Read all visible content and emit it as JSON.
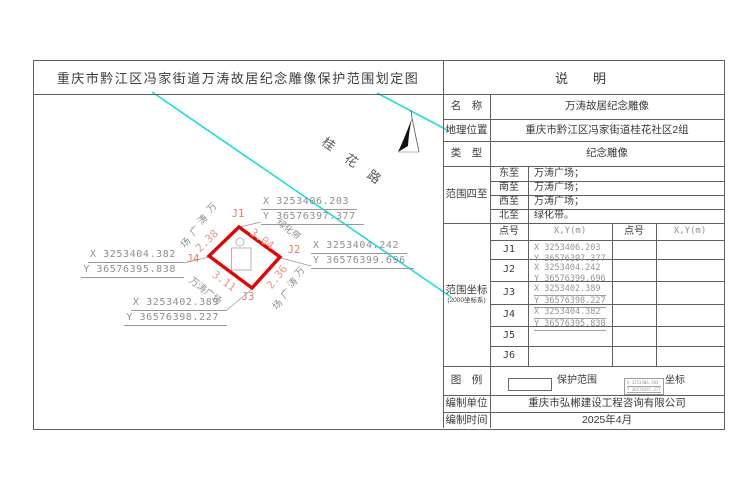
{
  "title": "重庆市黔江区冯家街道万涛故居纪念雕像保护范围划定图",
  "map": {
    "road_label": "桂花路",
    "green_belt_label": "绿化带",
    "square_labels": [
      "万涛广场",
      "万涛广场",
      "万涛广场"
    ],
    "points": [
      {
        "id": "J1",
        "x": "X 3253406.203",
        "y": "Y 36576397.377"
      },
      {
        "id": "J2",
        "x": "X 3253404.242",
        "y": "Y 36576399.696"
      },
      {
        "id": "J3",
        "x": "X 3253402.389",
        "y": "Y 36576398.227"
      },
      {
        "id": "J4",
        "x": "X 3253404.382",
        "y": "Y 36576395.838"
      }
    ],
    "side_lengths": [
      "2.38",
      "3.04",
      "2.36",
      "3.11"
    ]
  },
  "table": {
    "header": "说　明",
    "rows": {
      "name": {
        "label": "名　称",
        "value": "万涛故居纪念雕像"
      },
      "location": {
        "label": "地理位置",
        "value": "重庆市黔江区冯家街道桂花社区2组"
      },
      "type": {
        "label": "类　型",
        "value": "纪念雕像"
      },
      "bounds": {
        "label": "范围四至",
        "items": [
          {
            "dir": "东至",
            "value": "万涛广场；"
          },
          {
            "dir": "南至",
            "value": "万涛广场；"
          },
          {
            "dir": "西至",
            "value": "万涛广场；"
          },
          {
            "dir": "北至",
            "value": "绿化带。"
          }
        ]
      },
      "coords": {
        "label": "范围坐标",
        "sublabel": "(2000坐标系)",
        "header": {
          "point": "点号",
          "xy": "X,Y(m)",
          "point2": "点号",
          "xy2": "X,Y(m)"
        },
        "points": [
          {
            "id": "J1",
            "x": "X 3253406.203",
            "y": "Y 36576397.377"
          },
          {
            "id": "J2",
            "x": "X 3253404.242",
            "y": "Y 36576399.696"
          },
          {
            "id": "J3",
            "x": "X 3253402.389",
            "y": "Y 36576398.227"
          },
          {
            "id": "J4",
            "x": "X 3253404.382",
            "y": "Y 36576395.838"
          },
          {
            "id": "J5",
            "x": "",
            "y": ""
          },
          {
            "id": "J6",
            "x": "",
            "y": ""
          }
        ]
      },
      "legend": {
        "label": "图　例",
        "protection_label": "保护范围",
        "coordinate_label": "坐标",
        "sample_x": "X 3253406.203",
        "sample_y": "Y 36576397.377"
      },
      "author": {
        "label": "编制单位",
        "value": "重庆市弘郴建设工程咨询有限公司"
      },
      "date": {
        "label": "编制时间",
        "value": "2025年4月"
      }
    }
  },
  "colors": {
    "road": "#17dede",
    "protection_outline": "#e00505",
    "dimension_text": "#e5988c",
    "point_label": "#d9816b",
    "grid_line": "#606060"
  }
}
